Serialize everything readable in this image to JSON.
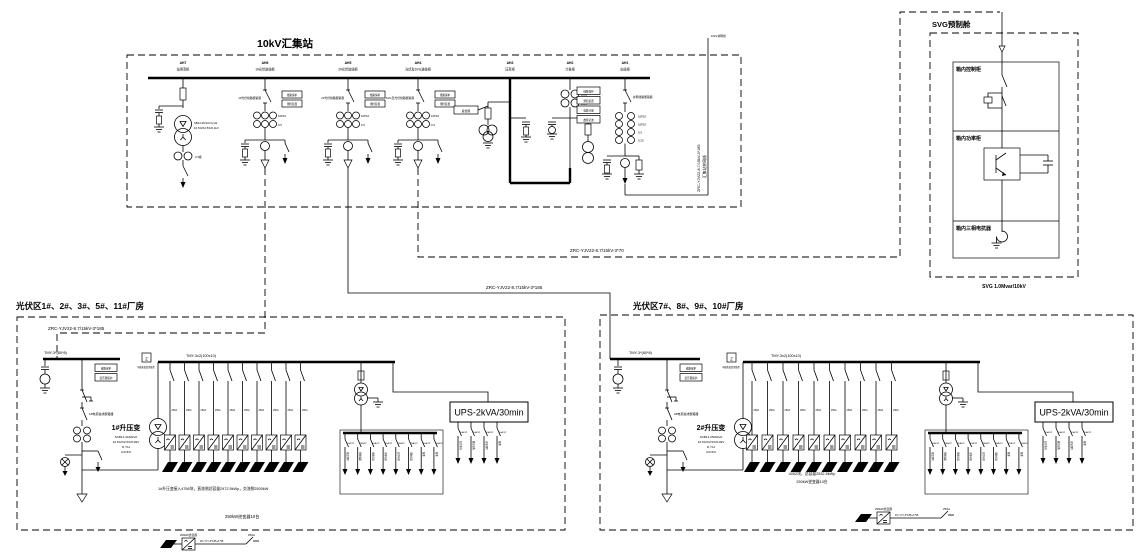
{
  "station": {
    "title": "10kV汇集站",
    "bays": [
      {
        "id": "AH7",
        "name": "站用变柜",
        "trafo_spec1": "SB14-30/10 Dyn11",
        "trafo_spec2": "10.5±2X2.5%/0.4kV",
        "ct": "0.5级"
      },
      {
        "id": "AH6",
        "name": "1#光伏进线柜",
        "breaker": "1#光伏线路断路器",
        "relays": [
          "线路保护",
          "测控装置"
        ],
        "ct1": "10P10",
        "ct2": "0.5"
      },
      {
        "id": "AH5",
        "name": "2#光伏进线柜",
        "breaker": "2#光伏线路断路器",
        "relays": [
          "线路保护",
          "测控装置"
        ],
        "ct1": "10P10",
        "ct2": "0.5"
      },
      {
        "id": "AH4",
        "name": "光伏及SVG进线柜",
        "breaker": "SVG及光伏线路断路器",
        "relays": [
          "线路保护",
          "测控装置"
        ],
        "ct1": "10P10",
        "ct2": "0.5"
      },
      {
        "id": "AH3",
        "name": "压变柜",
        "arrester_label": "避雷器"
      },
      {
        "id": "AH2",
        "name": "计量柜",
        "ct1": "0.2S",
        "ct2": "0.2S"
      },
      {
        "id": "AH1",
        "name": "出线柜",
        "breaker": "并网线路断路器",
        "relays": [
          "线路保护",
          "测控装置",
          "电能计量",
          "故障录波"
        ],
        "cts": [
          "10P10",
          "10P10",
          "0.5",
          "0.2S"
        ]
      }
    ],
    "outgoing": {
      "top_label": "10kV并网线",
      "cable": "ZRC-YJV22-8.7/15kV-3*185",
      "name": "汇集站并网线"
    }
  },
  "cables": {
    "to_svg": "ZRC-YJV22-8.7/15kV-3*70",
    "to_right_block": "ZRC-YJV22-8.7/15kV-3*185",
    "to_left_block": "ZRC-YJV22-8.7/15kV-3*185"
  },
  "svg_cabin": {
    "title": "SVG预制舱",
    "sections": [
      "箱内控制柜",
      "箱内功率柜",
      "箱内三相电抗器"
    ],
    "rating": "SVG 1.0Mvar/10kV"
  },
  "pv_left": {
    "title": "光伏区1#、2#、3#、5#、11#厂房",
    "hv_bus": "TMY-3*(80*8)",
    "lv_bus": "TMY-3x2(100x10)",
    "meter_box": "Z",
    "meter_label": "电能质量监测装置",
    "relays": [
      "线路保护",
      "变压器保护"
    ],
    "breaker": "1#电源进线断路器",
    "transformer": {
      "name": "1#升压变",
      "specs": [
        "SCB14-3150kVA",
        "10.5±2X2.5%/0.8kV",
        "D,Y11",
        "Ud=6%"
      ]
    },
    "strings": {
      "count": 10,
      "breaker_label": "250A"
    },
    "note": "1#升压变接入4756块，直流侧总容量2972.5kWp，交流侧2500kW",
    "inverter_count": "250kW逆变器10台",
    "aux_panel": {
      "breaker_label": "16A/1P",
      "feeders": [
        "箱变照明",
        "检修插座",
        "风机电源",
        "水泵电源",
        "监控电源",
        "消防电源",
        "备用",
        "备用"
      ]
    },
    "ups": {
      "label": "UPS-2kVA/30min",
      "breaker_label": "10A/1P",
      "feeders": [
        "监控系统",
        "通信设备",
        "应急照明",
        "备用"
      ]
    }
  },
  "pv_right": {
    "title": "光伏区7#、8#、9#、10#厂房",
    "hv_bus": "TMY-3*(80*8)",
    "lv_bus": "TMY-3x2(100x10)",
    "meter_box": "Z",
    "meter_label": "电能质量监测装置",
    "relays": [
      "线路保护",
      "变压器保护"
    ],
    "breaker": "2#电源进线断路器",
    "transformer": {
      "name": "2#升压变",
      "specs": [
        "SCB14-2500kVA",
        "10.5±2X2.5%/0.8kV",
        "D,Y11",
        "Ud=6%"
      ]
    },
    "strings": {
      "count": 10,
      "breaker_label": "250A"
    },
    "note1": "4052块，总容量2532.5kWp",
    "note2": "250kW逆变器10台",
    "aux_panel": {
      "breaker_label": "16A/1P",
      "feeders": [
        "箱变照明",
        "检修插座",
        "风机电源",
        "水泵电源",
        "监控电源",
        "消防电源",
        "备用",
        "备用"
      ]
    },
    "ups": {
      "label": "UPS-2kVA/30min",
      "breaker_label": "10A/1P",
      "feeders": [
        "监控系统",
        "通信设备",
        "应急照明",
        "备用"
      ]
    }
  },
  "legend": {
    "inverter": "250kW逆变器",
    "cable": "ZC-YJY-3*185+1*95",
    "breaker": "250A"
  }
}
